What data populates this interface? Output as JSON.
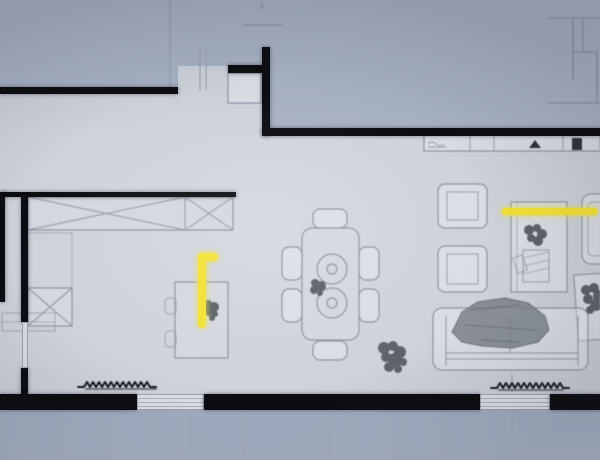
{
  "scene": {
    "type": "architectural-floor-plan",
    "view": "top-down",
    "visible_text": "none"
  },
  "palette": {
    "exterior": "#a8b2c5",
    "exterior_dark": "#a0abbf",
    "floor": "#cdd1da",
    "floor_light": "#d3d7e0",
    "wall": "#0c0d10",
    "outline": "#8d93a0",
    "outline_soft": "#9aa2b0",
    "window": "#d8dbe1",
    "highlight": "#f2e135",
    "plant": "#4f545c",
    "ink": "#17191d"
  },
  "highlights": [
    {
      "name": "desk-lamp-highlight",
      "shape": "L-shaped vertical bar",
      "color": "#f2e135",
      "area": "left room near desk"
    },
    {
      "name": "wall-light-highlight",
      "shape": "horizontal bar",
      "color": "#f2e135",
      "area": "right living wall above TV cabinet"
    }
  ],
  "rooms": [
    {
      "name": "bedroom-office",
      "contents": [
        "wardrobe",
        "laundry-unit",
        "storage-bench",
        "desk",
        "desk-plant",
        "highlighted-lamp"
      ]
    },
    {
      "name": "dining-area",
      "contents": [
        "dining-table",
        "six-chairs",
        "two-place-settings",
        "table-plant",
        "floor-plant"
      ]
    },
    {
      "name": "living-kitchen",
      "contents": [
        "kitchen-counter",
        "sink",
        "appliance",
        "two-armchairs",
        "tv-cabinet",
        "cabinet-plant",
        "sofa",
        "blanket",
        "side-table",
        "side-table-plant",
        "corner-armchair",
        "highlighted-wall-light"
      ]
    },
    {
      "name": "entry",
      "contents": [
        "entry-cabinet",
        "front-door"
      ]
    }
  ],
  "openings": {
    "bottom_windows": 2,
    "bottom_window_shrub_rows": 2,
    "left_interior_door": 1,
    "front_door_top": 1
  }
}
